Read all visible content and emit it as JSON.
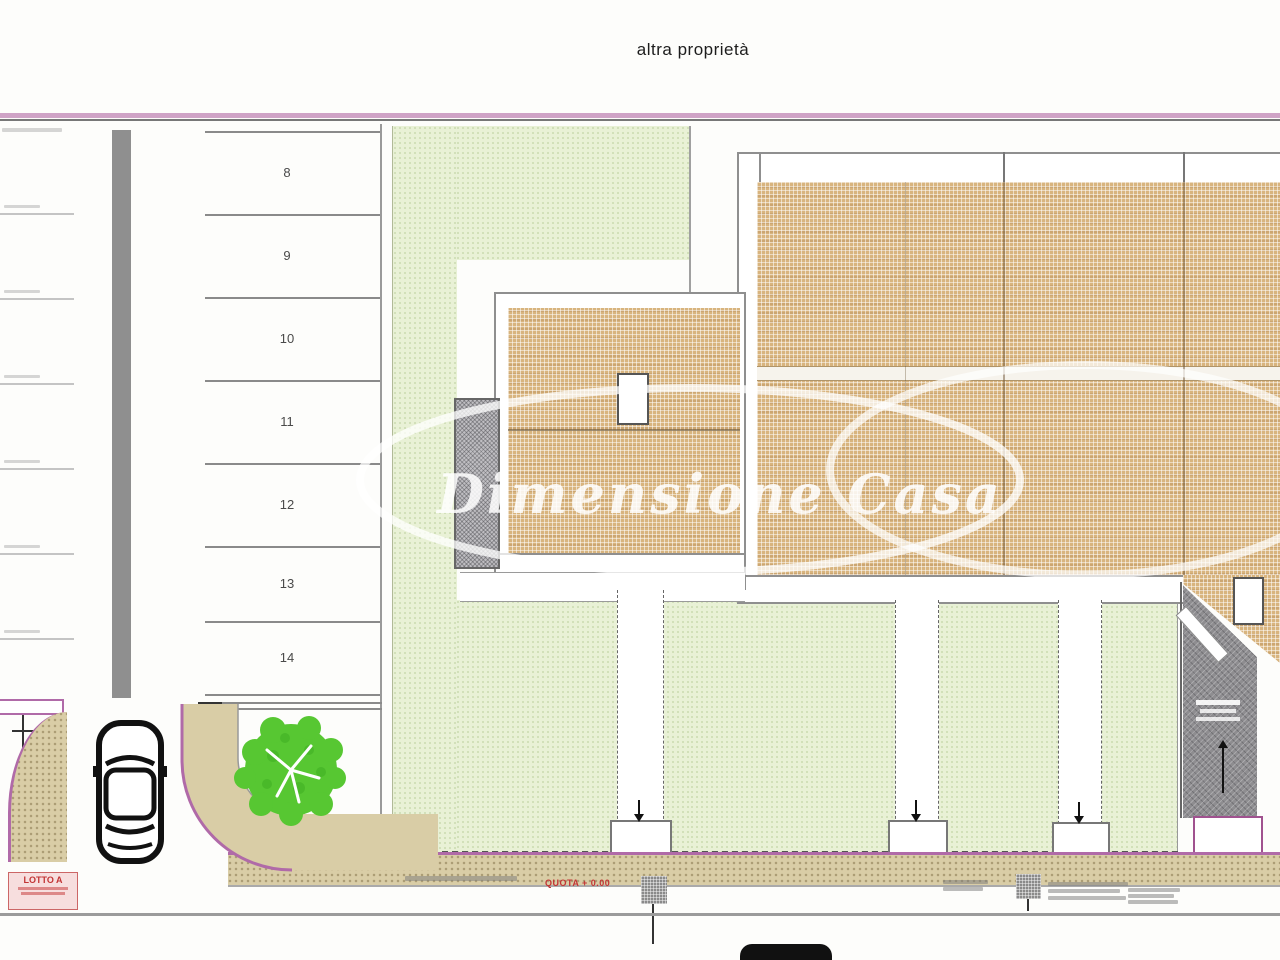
{
  "title": "altra proprietà",
  "watermark": "Dimensione Casa",
  "parking": {
    "stall_numbers": [
      "8",
      "9",
      "10",
      "11",
      "12",
      "13",
      "14"
    ]
  },
  "annotations": {
    "lotto": "LOTTO A",
    "quota": "QUOTA + 0.00"
  },
  "colors": {
    "boundary_pink": "#cfa3c6",
    "sidewalk_edge": "#b06aa8",
    "roof_hatch": "#d8b47e",
    "garden_green": "#e9f1d6",
    "ramp_gray": "#8e8d90",
    "tree_green": "#57c732",
    "label_red": "#c23434"
  }
}
